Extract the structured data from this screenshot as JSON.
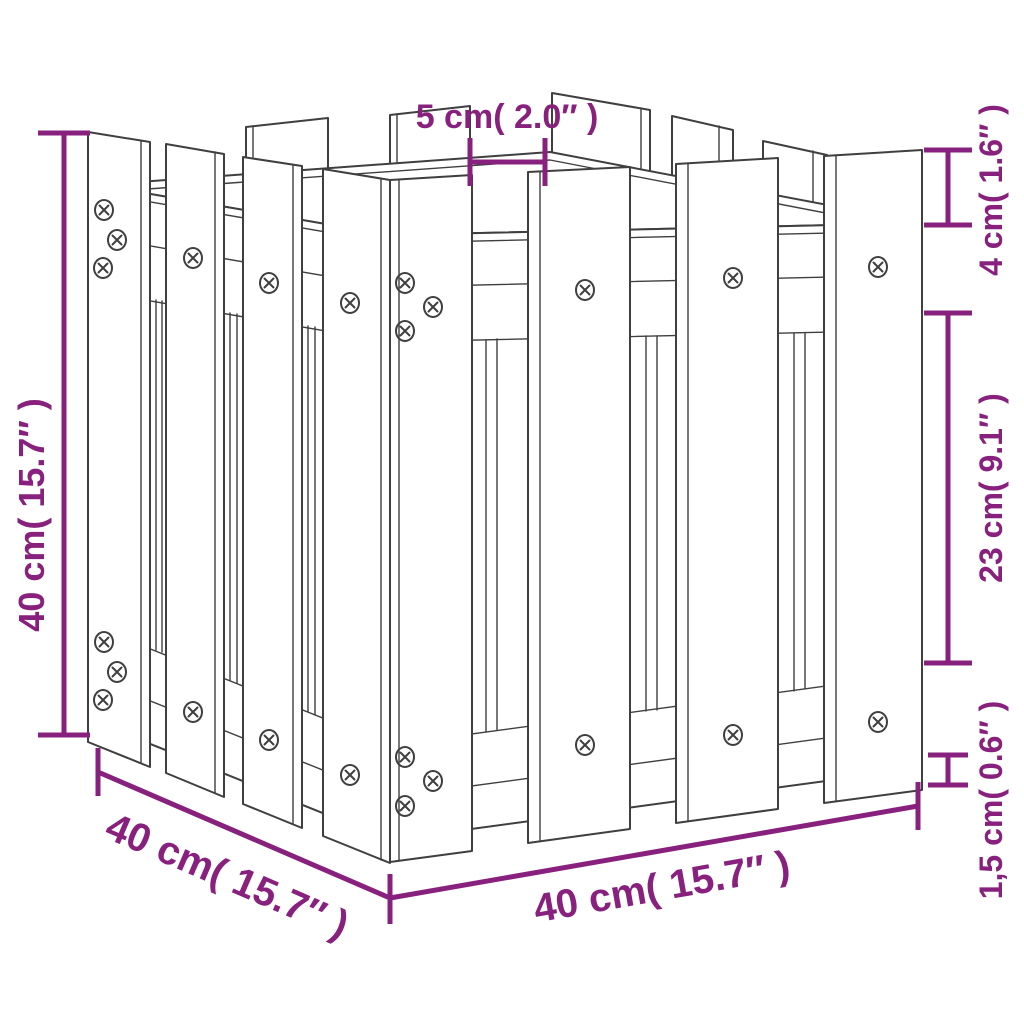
{
  "colors": {
    "background": "#ffffff",
    "line_art": "#3f3f3f",
    "dimension": "#88217d"
  },
  "dimensions": {
    "height_left": "40 cm( 15.7″ )",
    "picket_gap_top": "5 cm( 2.0″ )",
    "top_offset_right": "4 cm( 1.6″ )",
    "mid_span_right": "23 cm( 9.1″ )",
    "base_gap_right": "1,5 cm( 0.6″ )",
    "depth_bottom_left": "40 cm( 15.7″ )",
    "width_bottom": "40 cm( 15.7″ )"
  }
}
